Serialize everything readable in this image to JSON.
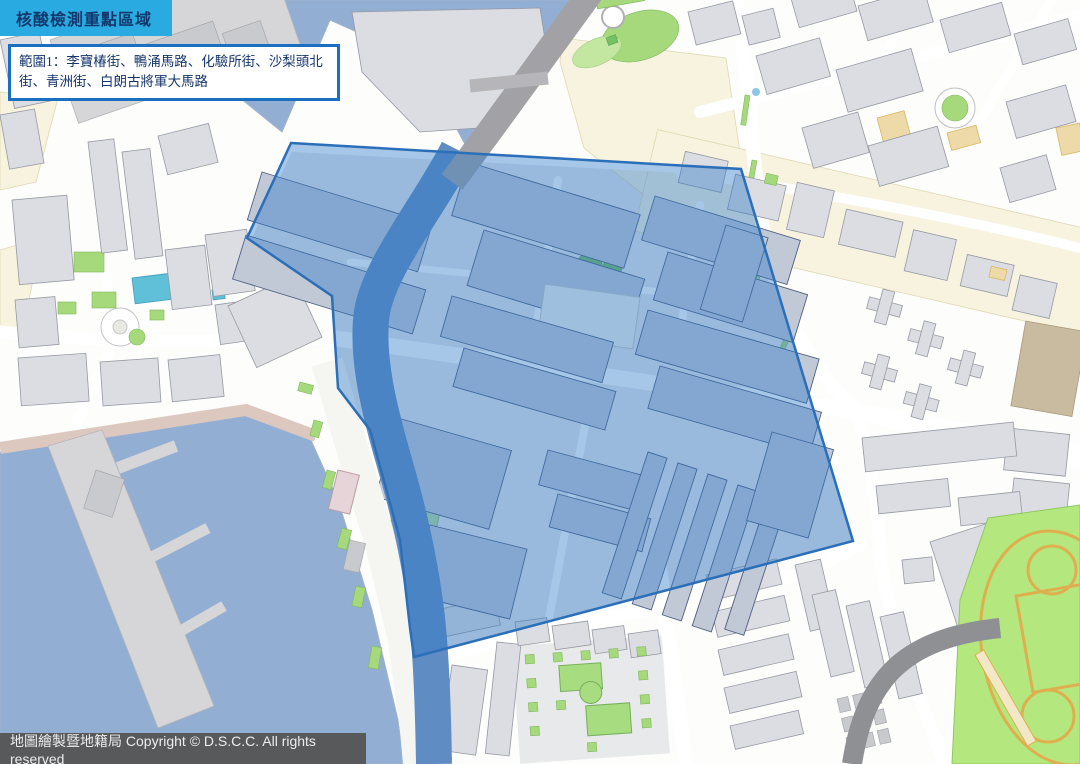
{
  "header": {
    "title": "核酸檢測重點區域"
  },
  "info_box": {
    "range_label": "範圍1",
    "streets": [
      "李寶椿街",
      "鴨涌馬路",
      "化驗所街",
      "沙梨頭北街",
      "青洲街",
      "白朗古將軍大馬路"
    ],
    "text": "範圍1：李寶椿街、鴨涌馬路、化驗所街、沙梨頭北街、青洲街、白朗古將軍大馬路"
  },
  "footer": {
    "text": "地圖繪製暨地籍局 Copyright © D.S.C.C. All rights reserved"
  },
  "map": {
    "highlight_zone": {
      "label": "範圍1",
      "fill": "#2E7AC8",
      "opacity": 0.42,
      "border": "#2B6FB8"
    },
    "palette": {
      "header_bg": "#29ABE2",
      "header_text": "#14386B",
      "info_border": "#1B6FC0",
      "info_text": "#16356B",
      "footer_bg": "#58595B",
      "footer_text": "#EDEDED",
      "water": "#93AED3",
      "canal": "#5F8CC2",
      "road": "#FFFFFF",
      "building": "#DCDDE2",
      "building_stroke": "#9599A4",
      "building_in": "#C2C9D6",
      "building_in_stroke": "#4E6084",
      "district": "#E7E9EA",
      "cream": "#F7F3DE",
      "green": "#A5D97B",
      "green_dark": "#74C063",
      "sports": "#B4E87E",
      "sports_line": "#DFAE4E",
      "flyover": "#A2A2A6",
      "pool": "#5FC0D8",
      "pier": "#D6D6D8",
      "mudflat": "#DCC8BF",
      "esplanade": "#F5F6F2",
      "track": "#8F9094",
      "hl_fill": "#2E7AC8",
      "hl_stroke": "#2B6FB8"
    }
  }
}
